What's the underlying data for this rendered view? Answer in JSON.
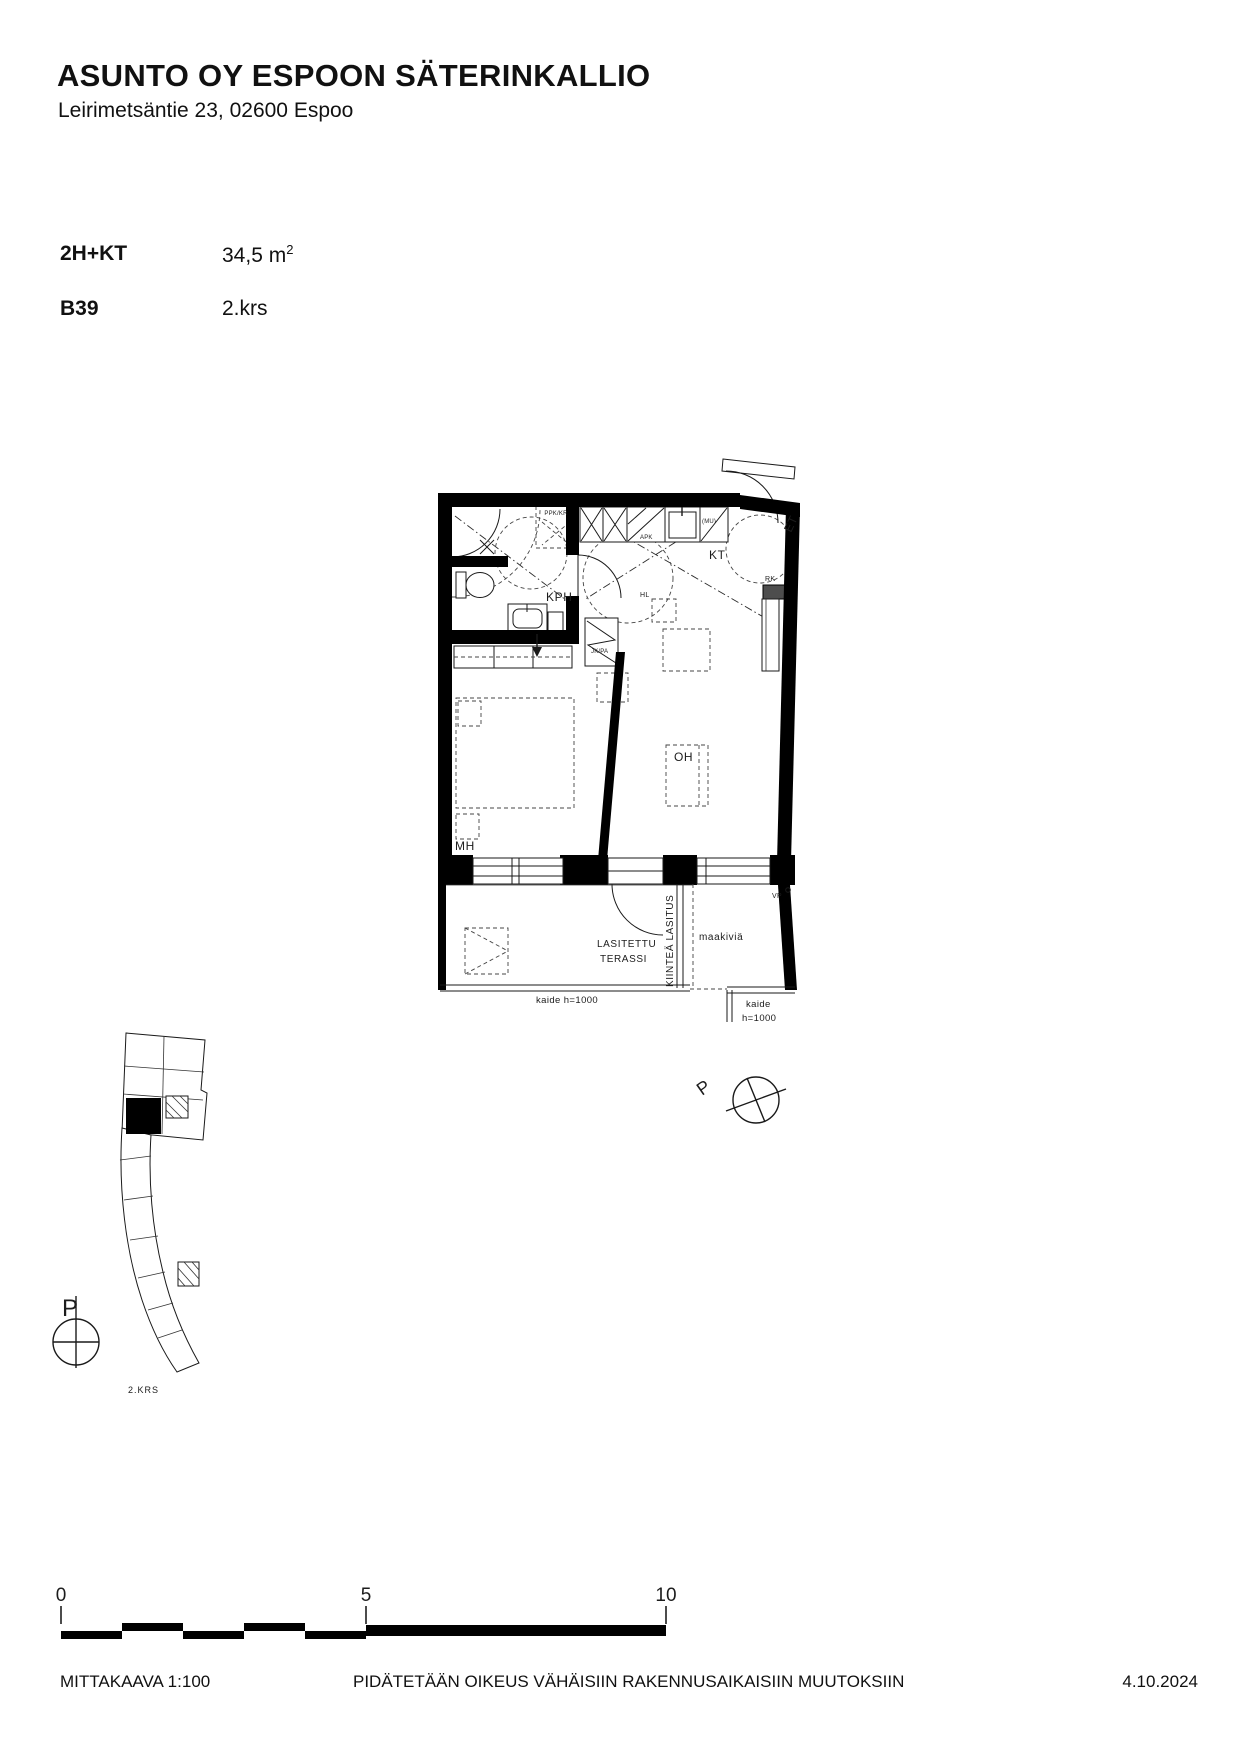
{
  "header": {
    "title": "ASUNTO OY ESPOON SÄTERINKALLIO",
    "address": "Leirimetsäntie 23, 02600 Espoo"
  },
  "apartment": {
    "type": "2H+KT",
    "area_value": "34,5 m",
    "area_exponent": "2",
    "unit": "B39",
    "floor": "2.krs"
  },
  "plan": {
    "rooms": {
      "kph": "KPH",
      "kt": "KT",
      "et": "ET",
      "mh": "MH",
      "oh": "OH"
    },
    "fixtures": {
      "rk": "RK",
      "apk": "APK",
      "mu": "(MU)",
      "hl": "HL",
      "jk_pa": "JK/PA",
      "ppk_kr": "PPK/KR",
      "vp": "VP"
    },
    "terrace": {
      "line1": "LASITETTU",
      "line2": "TERASSI",
      "fixed_glazing": "KIINTEÄ LASITUS",
      "ground_stone": "maakiviä",
      "railing_left": "kaide h=1000",
      "railing_right_line1": "kaide",
      "railing_right_line2": "h=1000"
    },
    "north_label": "P"
  },
  "site_plan": {
    "north_label": "P",
    "floor_label": "2.KRS"
  },
  "scale_bar": {
    "tick0": "0",
    "tick5": "5",
    "tick10": "10"
  },
  "footer": {
    "scale": "MITTAKAAVA 1:100",
    "disclaimer": "PIDÄTETÄÄN OIKEUS VÄHÄISIIN RAKENNUSAIKAISIIN MUUTOKSIIN",
    "date": "4.10.2024"
  }
}
